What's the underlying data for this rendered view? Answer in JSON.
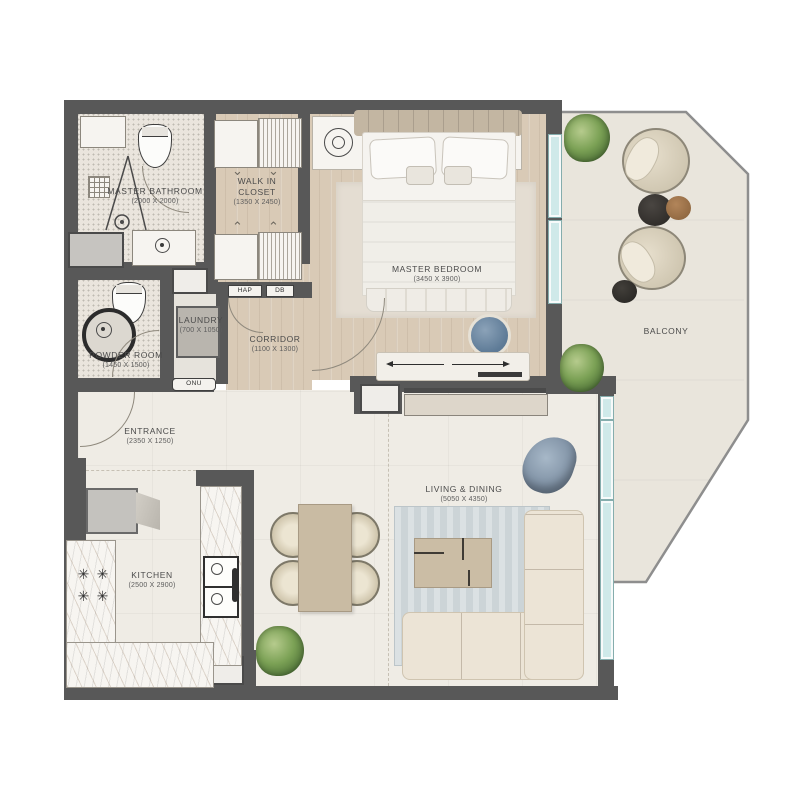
{
  "rooms": {
    "master_bathroom": {
      "label": "MASTER BATHROOM",
      "dims": "(2000 X 2000)"
    },
    "walk_in_closet": {
      "label": "WALK IN CLOSET",
      "dims": "(1350 X 2450)"
    },
    "master_bedroom": {
      "label": "MASTER BEDROOM",
      "dims": "(3450 X 3900)"
    },
    "powder_room": {
      "label": "POWDER ROOM",
      "dims": "(1450 X 1500)"
    },
    "laundry": {
      "label": "LAUNDRY",
      "dims": "(700 X 1050)"
    },
    "corridor": {
      "label": "CORRIDOR",
      "dims": "(1100 X 1300)"
    },
    "entrance": {
      "label": "ENTRANCE",
      "dims": "(2350 X 1250)"
    },
    "kitchen": {
      "label": "KITCHEN",
      "dims": "(2500 X 2900)"
    },
    "living_dining": {
      "label": "LIVING & DINING",
      "dims": "(5050 X 4350)"
    },
    "balcony": {
      "label": "BALCONY",
      "dims": ""
    }
  },
  "equipment": {
    "hap": "HAP",
    "db": "DB",
    "onu": "ONU"
  },
  "icons": {
    "closet_chevron_down": "⌄",
    "closet_chevron_up": "⌃",
    "hob_burner": "✳"
  },
  "colors": {
    "wall": "#585858",
    "wood_floor": "#d9cab6",
    "terrazzo_floor": "#eae5dd",
    "stone_floor": "#efece5",
    "balcony_floor": "#e9e5dc",
    "glazing": "#cfe9e9",
    "rug_living": "#ccd4d7",
    "rug_bedroom": "#e4ddd2",
    "sofa": "#ece4d6",
    "accent_chair": "#8da2b6",
    "plant": "#6f9150"
  }
}
